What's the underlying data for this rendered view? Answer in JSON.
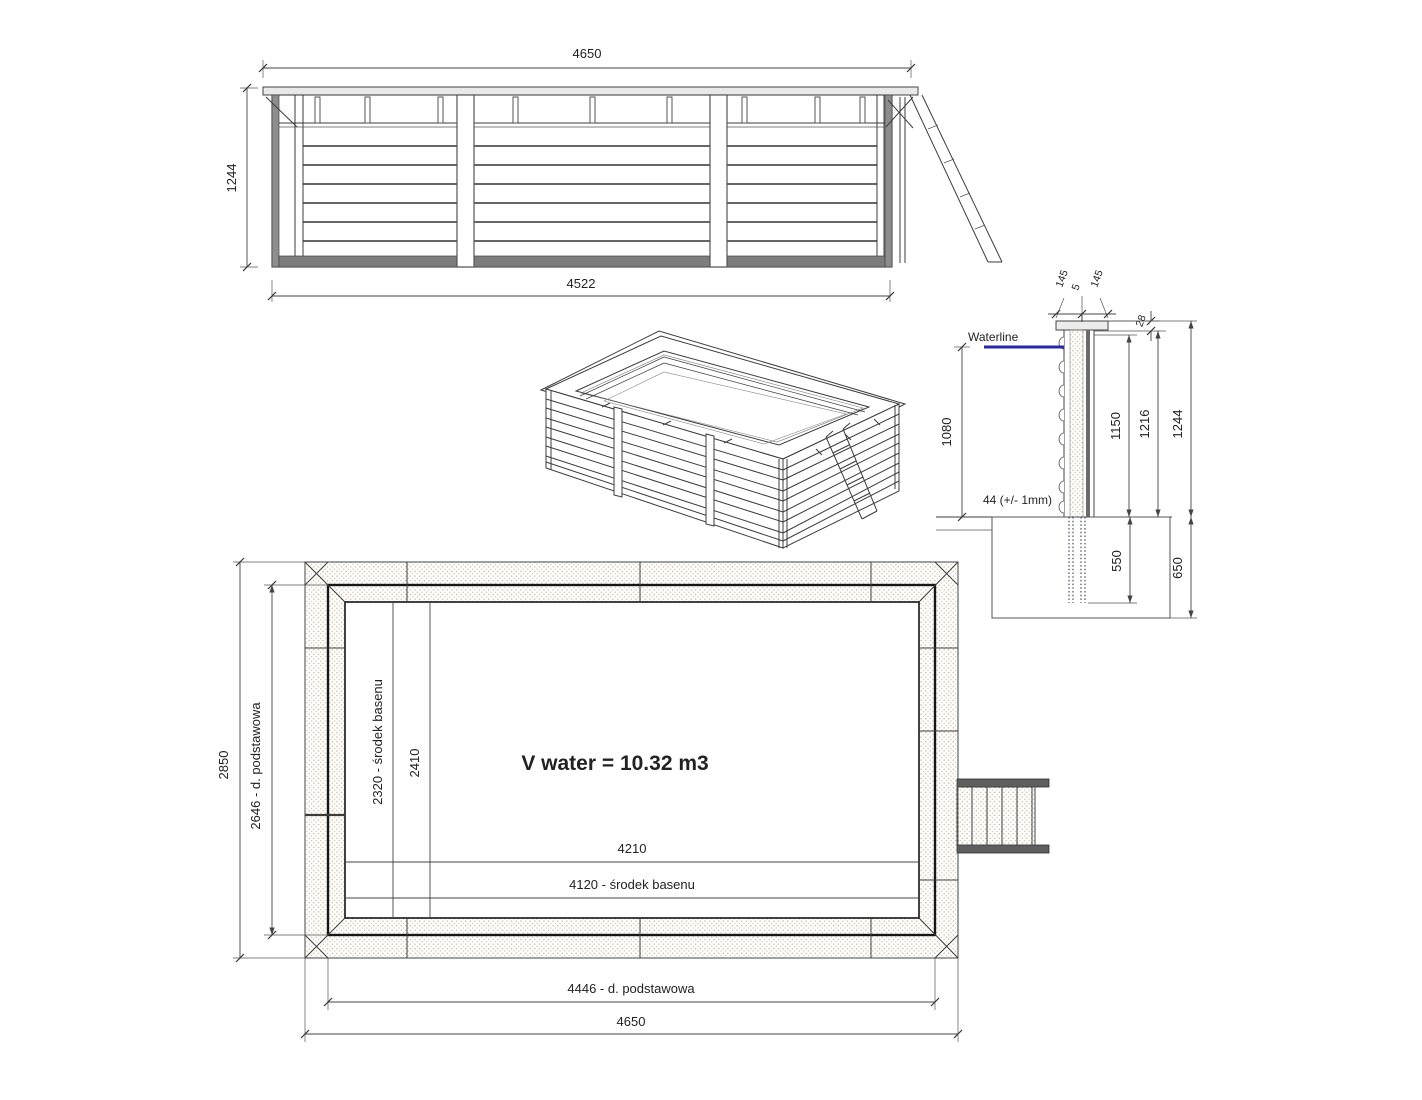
{
  "elevation": {
    "dim_top": "4650",
    "dim_left": "1244",
    "dim_bottom": "4522"
  },
  "section": {
    "dim_plank_left": "145",
    "dim_gap": "5",
    "dim_plank_right": "145",
    "dim_cap": "28",
    "waterline": "Waterline",
    "dim_water": "1080",
    "plank_note": "44 (+/- 1mm)",
    "dim_inner_height": "1150",
    "dim_mid_height": "1216",
    "dim_total_height": "1244",
    "dim_embed": "550",
    "dim_foundation": "650"
  },
  "plan": {
    "dim_outer_width": "2850",
    "dim_base_width": "2646 - d. podstawowa",
    "dim_center_width": "2320 - środek basenu",
    "dim_inner_width": "2410",
    "volume": "V water = 10.32 m3",
    "dim_inner_length": "4210",
    "dim_center_length": "4120 - środek basenu",
    "dim_base_length": "4446 - d. podstawowa",
    "dim_outer_length": "4650"
  },
  "colors": {
    "waterline_blue": "#2727ad",
    "wood_dot": "#bf9f76",
    "wood_dot2": "#cdb492",
    "wood_hatch": "#ad7347",
    "wood_hatch2": "#a86f46"
  }
}
